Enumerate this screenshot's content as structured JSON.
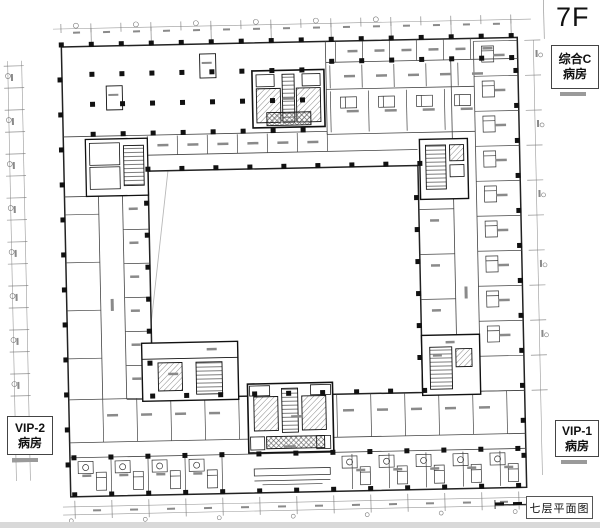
{
  "floor_plan": {
    "floor_label": "7F",
    "plan_title": "七层平面图",
    "ward_boxes": {
      "general_c": {
        "line1": "综合C",
        "line2": "病房"
      },
      "vip2": {
        "line1": "VIP-2",
        "line2": "病房"
      },
      "vip1": {
        "line1": "VIP-1",
        "line2": "病房"
      }
    },
    "colors": {
      "wall": "#222222",
      "partition": "#444444",
      "dimension": "#999999",
      "faint_outline": "#b8b8b8"
    }
  }
}
